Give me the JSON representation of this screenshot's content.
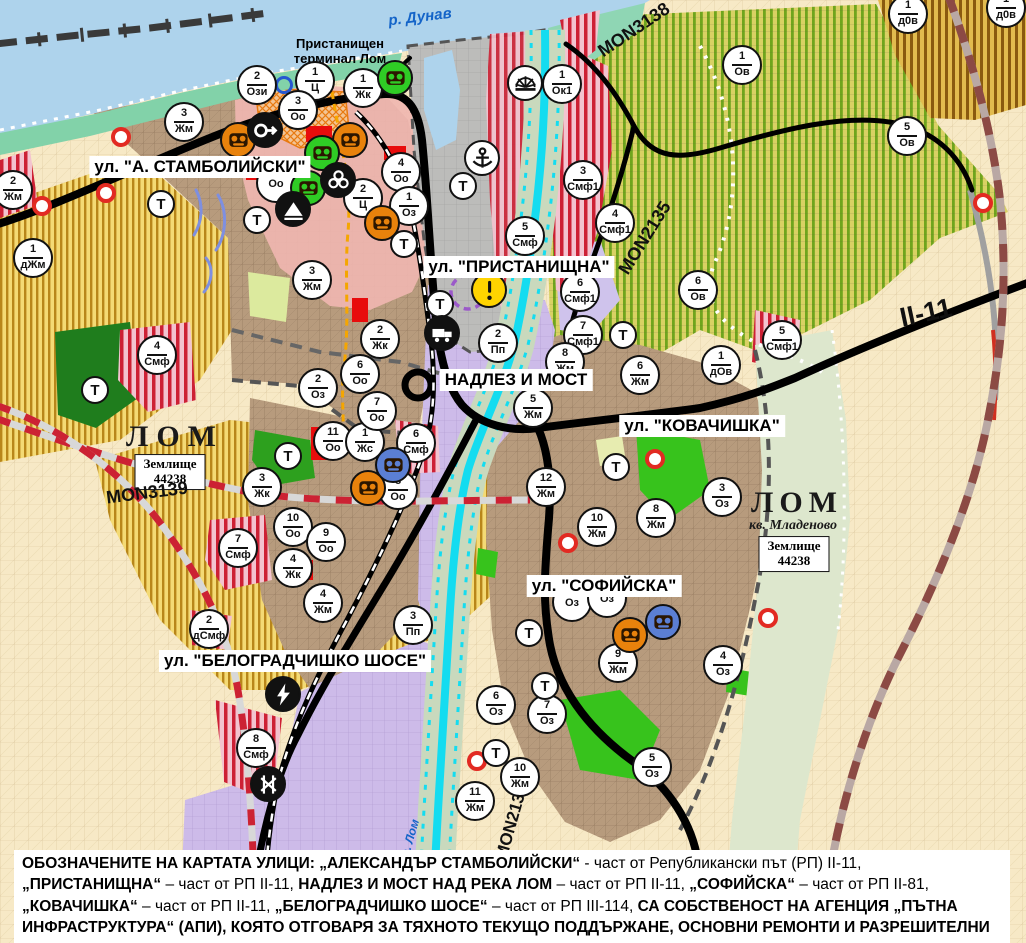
{
  "map": {
    "colors": {
      "water": "#aed3ec",
      "river_lom": "#14dcf0",
      "road_black": "#000000",
      "border_red": "#cc2233",
      "vineyard_green": "#6fa51d",
      "agri_yellow": "#b8861a",
      "smf_red": "#cd2034",
      "town_brown": "#b79b7d",
      "pp_purple": "#cdbbe9",
      "park_green": "#2da01e",
      "warning_yellow": "#ffd400",
      "poi_orange": "#e8820c",
      "poi_green": "#2fcc25",
      "poi_blue": "#5b7fd4"
    },
    "water_labels": [
      {
        "text": "р. Дунав",
        "x": 420,
        "y": 17,
        "rot": -7,
        "size": 15
      },
      {
        "text": "р. Лом",
        "x": 410,
        "y": 838,
        "rot": -74,
        "size": 12
      }
    ],
    "port_label": {
      "line1": "Пристанищен",
      "line2": "терминал Лом",
      "x": 340,
      "y": 52
    },
    "street_labels": [
      {
        "text": "ул. \"А. СТАМБОЛИЙСКИ\"",
        "x": 200,
        "y": 167
      },
      {
        "text": "ул. \"ПРИСТАНИЩНА\"",
        "x": 519,
        "y": 267
      },
      {
        "text": "НАДЛЕЗ И МОСТ",
        "x": 516,
        "y": 380
      },
      {
        "text": "ул. \"КОВАЧИШКА\"",
        "x": 702,
        "y": 426
      },
      {
        "text": "ул. \"СОФИЙСКА\"",
        "x": 604,
        "y": 586
      },
      {
        "text": "ул. \"БЕЛОГРАДЧИШКО ШОСЕ\"",
        "x": 295,
        "y": 661
      }
    ],
    "road_labels": [
      {
        "text": "MON3138",
        "x": 634,
        "y": 30,
        "rot": -34,
        "size": 18
      },
      {
        "text": "MON2135",
        "x": 645,
        "y": 238,
        "rot": -58,
        "size": 18
      },
      {
        "text": "MON3139",
        "x": 147,
        "y": 493,
        "rot": -7,
        "size": 18
      },
      {
        "text": "MON2136",
        "x": 512,
        "y": 822,
        "rot": -74,
        "size": 17
      },
      {
        "text": "II-11",
        "x": 926,
        "y": 313,
        "rot": -12,
        "size": 27
      }
    ],
    "place_labels": [
      {
        "text": "ЛОМ",
        "x": 175,
        "y": 437,
        "size": 30,
        "ls": 8,
        "italic": false
      },
      {
        "text": "ЛОМ",
        "x": 797,
        "y": 503,
        "size": 30,
        "ls": 6,
        "italic": false
      },
      {
        "text": "кв. Младеново",
        "x": 793,
        "y": 526,
        "size": 14,
        "ls": 0,
        "italic": true
      }
    ],
    "land_plot_boxes": [
      {
        "line1": "Землище",
        "line2": "44238",
        "x": 170,
        "y": 472
      },
      {
        "line1": "Землище",
        "line2": "44238",
        "x": 794,
        "y": 554
      }
    ],
    "zone_markers": [
      {
        "n": "2",
        "c": "Ози",
        "x": 257,
        "y": 85
      },
      {
        "n": "1",
        "c": "Ц",
        "x": 315,
        "y": 81
      },
      {
        "n": "1",
        "c": "Жк",
        "x": 363,
        "y": 88
      },
      {
        "n": "3",
        "c": "Оо",
        "x": 298,
        "y": 110
      },
      {
        "n": "3",
        "c": "Жм",
        "x": 184,
        "y": 122
      },
      {
        "n": "2",
        "c": "Жм",
        "x": 13,
        "y": 190
      },
      {
        "n": "1",
        "c": "дЖм",
        "x": 33,
        "y": 258
      },
      {
        "n": "3",
        "c": "Жм",
        "x": 312,
        "y": 280
      },
      {
        "n": "4",
        "c": "Оо",
        "x": 401,
        "y": 172
      },
      {
        "n": "2",
        "c": "Ц",
        "x": 363,
        "y": 198
      },
      {
        "n": "1",
        "c": "Оз",
        "x": 409,
        "y": 206
      },
      {
        "n": "",
        "c": "Оо",
        "x": 276,
        "y": 183
      },
      {
        "n": "2",
        "c": "Жк",
        "x": 380,
        "y": 339
      },
      {
        "n": "5",
        "c": "Смф",
        "x": 525,
        "y": 236
      },
      {
        "n": "1",
        "c": "Ок1",
        "x": 562,
        "y": 84
      },
      {
        "n": "3",
        "c": "Смф1",
        "x": 583,
        "y": 180
      },
      {
        "n": "1",
        "c": "Ов",
        "x": 742,
        "y": 65
      },
      {
        "n": "1",
        "c": "д0в",
        "x": 908,
        "y": 14
      },
      {
        "n": "1",
        "c": "д0в",
        "x": 1006,
        "y": 8
      },
      {
        "n": "5",
        "c": "Ов",
        "x": 907,
        "y": 136
      },
      {
        "n": "4",
        "c": "Смф1",
        "x": 615,
        "y": 223
      },
      {
        "n": "6",
        "c": "Ов",
        "x": 698,
        "y": 290
      },
      {
        "n": "6",
        "c": "Смф1",
        "x": 580,
        "y": 292
      },
      {
        "n": "7",
        "c": "Смф1",
        "x": 583,
        "y": 335
      },
      {
        "n": "5",
        "c": "Смф1",
        "x": 782,
        "y": 340
      },
      {
        "n": "1",
        "c": "дОв",
        "x": 721,
        "y": 365
      },
      {
        "n": "6",
        "c": "Жм",
        "x": 640,
        "y": 375
      },
      {
        "n": "2",
        "c": "Пп",
        "x": 498,
        "y": 343
      },
      {
        "n": "8",
        "c": "Жм",
        "x": 565,
        "y": 362
      },
      {
        "n": "5",
        "c": "Жм",
        "x": 533,
        "y": 408
      },
      {
        "n": "6",
        "c": "Смф",
        "x": 416,
        "y": 443
      },
      {
        "n": "8",
        "c": "Оо",
        "x": 398,
        "y": 490
      },
      {
        "n": "2",
        "c": "Оз",
        "x": 318,
        "y": 388
      },
      {
        "n": "11",
        "c": "Оо",
        "x": 333,
        "y": 441
      },
      {
        "n": "1",
        "c": "Жс",
        "x": 365,
        "y": 442
      },
      {
        "n": "6",
        "c": "Оо",
        "x": 360,
        "y": 374
      },
      {
        "n": "7",
        "c": "Оо",
        "x": 377,
        "y": 411
      },
      {
        "n": "3",
        "c": "Жк",
        "x": 262,
        "y": 487
      },
      {
        "n": "10",
        "c": "Оо",
        "x": 293,
        "y": 527
      },
      {
        "n": "9",
        "c": "Оо",
        "x": 326,
        "y": 542
      },
      {
        "n": "4",
        "c": "Жк",
        "x": 293,
        "y": 568
      },
      {
        "n": "7",
        "c": "Смф",
        "x": 238,
        "y": 548
      },
      {
        "n": "4",
        "c": "Смф",
        "x": 157,
        "y": 355
      },
      {
        "n": "12",
        "c": "Жм",
        "x": 546,
        "y": 487
      },
      {
        "n": "10",
        "c": "Жм",
        "x": 597,
        "y": 527
      },
      {
        "n": "8",
        "c": "Жм",
        "x": 656,
        "y": 518
      },
      {
        "n": "3",
        "c": "Оз",
        "x": 722,
        "y": 497
      },
      {
        "n": "9",
        "c": "Жм",
        "x": 618,
        "y": 663
      },
      {
        "n": "4",
        "c": "Оз",
        "x": 723,
        "y": 665
      },
      {
        "n": "6",
        "c": "Оз",
        "x": 496,
        "y": 705
      },
      {
        "n": "7",
        "c": "Оз",
        "x": 547,
        "y": 714
      },
      {
        "n": "5",
        "c": "Оз",
        "x": 652,
        "y": 767
      },
      {
        "n": "10",
        "c": "Жм",
        "x": 520,
        "y": 777
      },
      {
        "n": "11",
        "c": "Жм",
        "x": 475,
        "y": 801
      },
      {
        "n": "2",
        "c": "дСмф",
        "x": 209,
        "y": 629
      },
      {
        "n": "4",
        "c": "Жм",
        "x": 323,
        "y": 603
      },
      {
        "n": "3",
        "c": "Пп",
        "x": 413,
        "y": 625
      },
      {
        "n": "8",
        "c": "Смф",
        "x": 256,
        "y": 748
      },
      {
        "n": "",
        "c": "Оз",
        "x": 572,
        "y": 602
      },
      {
        "n": "",
        "c": "Оз",
        "x": 607,
        "y": 598
      }
    ],
    "t_markers": [
      {
        "x": 161,
        "y": 204
      },
      {
        "x": 257,
        "y": 220
      },
      {
        "x": 404,
        "y": 244
      },
      {
        "x": 463,
        "y": 186
      },
      {
        "x": 440,
        "y": 304
      },
      {
        "x": 95,
        "y": 390
      },
      {
        "x": 288,
        "y": 456
      },
      {
        "x": 623,
        "y": 335
      },
      {
        "x": 616,
        "y": 467
      },
      {
        "x": 529,
        "y": 633
      },
      {
        "x": 545,
        "y": 686
      },
      {
        "x": 496,
        "y": 753
      }
    ],
    "poi_icons": [
      {
        "type": "factory-orange",
        "x": 238,
        "y": 140
      },
      {
        "type": "factory-orange",
        "x": 350,
        "y": 140
      },
      {
        "type": "factory-orange",
        "x": 382,
        "y": 223
      },
      {
        "type": "factory-orange",
        "x": 368,
        "y": 488
      },
      {
        "type": "factory-orange",
        "x": 630,
        "y": 635
      },
      {
        "type": "factory-green",
        "x": 395,
        "y": 78
      },
      {
        "type": "factory-green",
        "x": 322,
        "y": 153
      },
      {
        "type": "factory-green",
        "x": 308,
        "y": 188
      },
      {
        "type": "factory-blue",
        "x": 393,
        "y": 465
      },
      {
        "type": "factory-blue",
        "x": 663,
        "y": 622
      },
      {
        "type": "arrow-circle",
        "x": 265,
        "y": 130
      },
      {
        "type": "trefoil",
        "x": 338,
        "y": 180
      },
      {
        "type": "mountain",
        "x": 293,
        "y": 209
      },
      {
        "type": "anchor",
        "x": 482,
        "y": 158
      },
      {
        "type": "sun-fan",
        "x": 525,
        "y": 83
      },
      {
        "type": "warning",
        "x": 489,
        "y": 290
      },
      {
        "type": "truck",
        "x": 442,
        "y": 333
      },
      {
        "type": "lightning",
        "x": 283,
        "y": 694
      },
      {
        "type": "rail-crossing",
        "x": 268,
        "y": 784
      },
      {
        "type": "blue-ring",
        "x": 284,
        "y": 85
      },
      {
        "type": "red-dot",
        "x": 121,
        "y": 137
      },
      {
        "type": "red-dot",
        "x": 106,
        "y": 193
      },
      {
        "type": "red-dot",
        "x": 42,
        "y": 206
      },
      {
        "type": "red-dot",
        "x": 568,
        "y": 543
      },
      {
        "type": "red-dot",
        "x": 655,
        "y": 459
      },
      {
        "type": "red-dot",
        "x": 768,
        "y": 618
      },
      {
        "type": "red-dot",
        "x": 477,
        "y": 761
      },
      {
        "type": "red-dot",
        "x": 983,
        "y": 203
      }
    ],
    "note_segments": [
      {
        "t": "ОБОЗНАЧЕНИТЕ НА КАРТАТА УЛИЦИ: „АЛЕКСАНДЪР СТАМБОЛИЙСКИ“",
        "b": true
      },
      {
        "t": " - част от Републикански път (РП) II-11, ",
        "b": false
      },
      {
        "t": "„ПРИСТАНИЩНА“",
        "b": true
      },
      {
        "t": " – част от РП II-11, ",
        "b": false
      },
      {
        "t": "НАДЛЕЗ И МОСТ НАД РЕКА ЛОМ",
        "b": true
      },
      {
        "t": " – част от РП II-11, ",
        "b": false
      },
      {
        "t": "„СОФИЙСКА“",
        "b": true
      },
      {
        "t": " – част от РП II-81, ",
        "b": false
      },
      {
        "t": "„КОВАЧИШКА“",
        "b": true
      },
      {
        "t": " – част от РП II-11, ",
        "b": false
      },
      {
        "t": "„БЕЛОГРАДЧИШКО ШОСЕ“",
        "b": true
      },
      {
        "t": " – част от РП III-114, ",
        "b": false
      },
      {
        "t": "СА СОБСТВЕНОСТ НА АГЕНЦИЯ „ПЪТНА ИНФРАСТРУКТУРА“ (АПИ), КОЯТО ОТГОВАРЯ ЗА ТЯХНОТО ТЕКУЩО ПОДДЪРЖАНЕ, ОСНОВНИ РЕМОНТИ И РАЗРЕШИТЕЛНИ РЕЖИМИ.",
        "b": true
      }
    ]
  }
}
